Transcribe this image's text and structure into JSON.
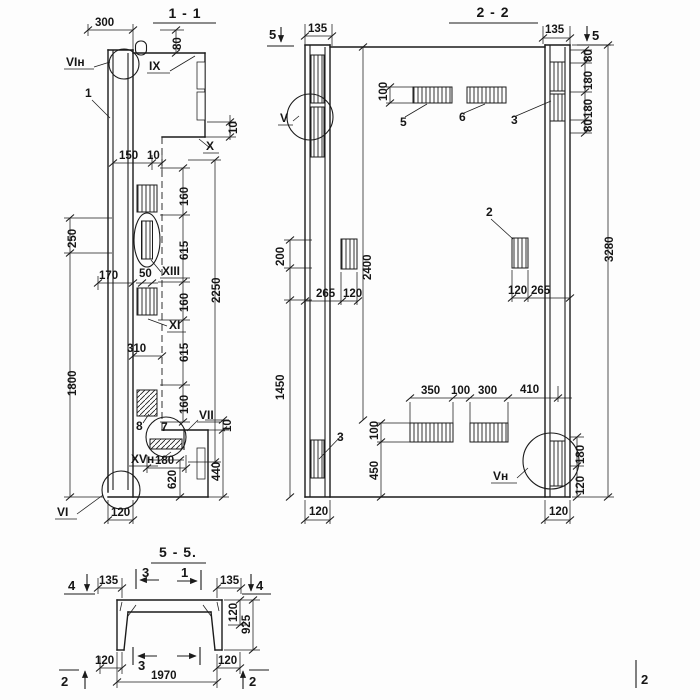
{
  "s11": {
    "title": "1 - 1",
    "parts": {
      "p1": "1",
      "p7": "7",
      "p8": "8"
    },
    "callouts": {
      "vin": "VIн",
      "ix": "IX",
      "x": "X",
      "xiii": "XIII",
      "xi": "XI",
      "vii": "VII",
      "xvn": "XVн",
      "vi": "VI"
    },
    "dims": {
      "d300": "300",
      "d80": "80",
      "d10a": "10",
      "d150": "150",
      "d10b": "10",
      "d250": "250",
      "d170": "170",
      "d50": "50",
      "d160a": "160",
      "d615a": "615",
      "d160b": "160",
      "d615b": "615",
      "d160c": "160",
      "d2250": "2250",
      "d310": "310",
      "d1800": "1800",
      "d180": "180",
      "d620": "620",
      "d10c": "10",
      "d440": "440",
      "d120": "120"
    }
  },
  "s22": {
    "title": "2 - 2",
    "parts": {
      "p2": "2",
      "p3a": "3",
      "p3b": "3",
      "p5": "5",
      "p6": "6"
    },
    "callouts": {
      "v": "V",
      "vn": "Vн"
    },
    "markers": {
      "m5l": "5",
      "m5r": "5"
    },
    "dims": {
      "d135l": "135",
      "d135r": "135",
      "d80a": "80",
      "d180a": "180",
      "d180b": "180",
      "d80b": "80",
      "d100a": "100",
      "d200": "200",
      "d2400": "2400",
      "d3280": "3280",
      "d265l": "265",
      "d120lm": "120",
      "d120rm": "120",
      "d265r": "265",
      "d1450": "1450",
      "d350": "350",
      "d100b": "100",
      "d300": "300",
      "d410": "410",
      "d100c": "100",
      "d450": "450",
      "d180c": "180",
      "d120rb": "120",
      "d120bl": "120",
      "d120br": "120"
    }
  },
  "s55": {
    "title": "5 - 5.",
    "markers": {
      "m4l": "4",
      "m3t": "3",
      "m1t": "1",
      "m4r": "4",
      "m2l": "2",
      "m3b": "3",
      "m2r": "2",
      "m2c": "2"
    },
    "dims": {
      "d135l": "135",
      "d135r": "135",
      "d120r": "120",
      "d925": "925",
      "d120bl": "120",
      "d120br": "120",
      "d1970": "1970"
    }
  }
}
